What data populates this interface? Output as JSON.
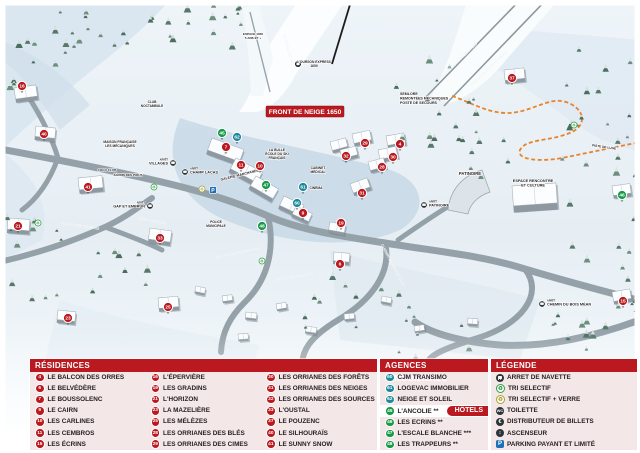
{
  "colors": {
    "red": "#b9191f",
    "green": "#169a48",
    "teal": "#1d8a9c",
    "panel_bg": "#f3e7e7",
    "parking_blue": "#1d70b7",
    "orange": "#e8832a"
  },
  "map": {
    "banner": "FRONT DE NEIGE 1650",
    "arret_word": "ARRÊT",
    "markers": [
      {
        "n": "16",
        "kind": "res",
        "x": 22,
        "y": 86
      },
      {
        "n": "40",
        "kind": "res",
        "x": 44,
        "y": 134
      },
      {
        "n": "21",
        "kind": "res",
        "x": 18,
        "y": 226
      },
      {
        "n": "41",
        "kind": "res",
        "x": 88,
        "y": 187
      },
      {
        "n": "33",
        "kind": "res",
        "x": 160,
        "y": 238
      },
      {
        "n": "25",
        "kind": "res",
        "x": 168,
        "y": 307
      },
      {
        "n": "23",
        "kind": "res",
        "x": 68,
        "y": 318
      },
      {
        "n": "7",
        "kind": "res",
        "x": 226,
        "y": 147
      },
      {
        "n": "11",
        "kind": "res",
        "x": 241,
        "y": 165
      },
      {
        "n": "10",
        "kind": "res",
        "x": 260,
        "y": 166
      },
      {
        "n": "9",
        "kind": "res",
        "x": 303,
        "y": 213
      },
      {
        "n": "19",
        "kind": "res",
        "x": 341,
        "y": 223
      },
      {
        "n": "6",
        "kind": "res",
        "x": 340,
        "y": 264
      },
      {
        "n": "29",
        "kind": "res",
        "x": 365,
        "y": 143
      },
      {
        "n": "4",
        "kind": "res",
        "x": 400,
        "y": 144
      },
      {
        "n": "32",
        "kind": "res",
        "x": 346,
        "y": 156
      },
      {
        "n": "30",
        "kind": "res",
        "x": 393,
        "y": 157
      },
      {
        "n": "28",
        "kind": "res",
        "x": 382,
        "y": 167
      },
      {
        "n": "31",
        "kind": "res",
        "x": 362,
        "y": 193
      },
      {
        "n": "37",
        "kind": "res",
        "x": 512,
        "y": 78
      },
      {
        "n": "15",
        "kind": "res",
        "x": 623,
        "y": 301
      },
      {
        "n": "45",
        "kind": "hotel",
        "x": 222,
        "y": 133
      },
      {
        "n": "47",
        "kind": "hotel",
        "x": 266,
        "y": 185
      },
      {
        "n": "48",
        "kind": "hotel",
        "x": 262,
        "y": 226
      },
      {
        "n": "46",
        "kind": "hotel",
        "x": 622,
        "y": 195
      },
      {
        "n": "62",
        "kind": "agency",
        "x": 237,
        "y": 137
      },
      {
        "n": "61",
        "kind": "agency",
        "x": 303,
        "y": 187
      },
      {
        "n": "60",
        "kind": "agency",
        "x": 297,
        "y": 203
      }
    ],
    "poi_labels": [
      {
        "lines": [
          "SEMLORE",
          "REMONTÉES MÉCANIQUES",
          "POSTE DE SECOURS"
        ],
        "x": 400,
        "y": 95,
        "size": 3.6,
        "anchor": "start"
      },
      {
        "lines": [
          "PATINOIRE"
        ],
        "x": 470,
        "y": 175,
        "size": 4.2,
        "anchor": "middle"
      },
      {
        "lines": [
          "ESPACE RENCONTRE",
          "ET CULTURE"
        ],
        "x": 533,
        "y": 182,
        "size": 3.8,
        "anchor": "middle"
      },
      {
        "lines": [
          "LA BULLE",
          "ÉCOLE DU SKI",
          "FRANÇAIS"
        ],
        "x": 277,
        "y": 151,
        "size": 3.3,
        "anchor": "middle"
      },
      {
        "lines": [
          "CABINET",
          "MÉDICAL"
        ],
        "x": 318,
        "y": 169,
        "size": 3.3,
        "anchor": "middle"
      },
      {
        "lines": [
          "CINÉMA"
        ],
        "x": 316,
        "y": 189,
        "size": 3.3,
        "anchor": "middle"
      },
      {
        "lines": [
          "GALERIE MARCHANDE"
        ],
        "x": 240,
        "y": 176,
        "size": 3.5,
        "anchor": "middle",
        "rot": -14
      },
      {
        "lines": [
          "MAISON FRANÇAISE",
          "LES MÉCANIQUES"
        ],
        "x": 120,
        "y": 143,
        "size": 3.3,
        "anchor": "middle"
      },
      {
        "lines": [
          "CLUB",
          "NOCTAMBULE"
        ],
        "x": 152,
        "y": 103,
        "size": 3.2,
        "anchor": "middle"
      },
      {
        "lines": [
          "COCO CLUB"
        ],
        "x": 107,
        "y": 171,
        "size": 3.1,
        "anchor": "middle"
      },
      {
        "lines": [
          "JARDIN DES PIOUS"
        ],
        "x": 128,
        "y": 176,
        "size": 3.1,
        "anchor": "middle"
      },
      {
        "lines": [
          "POLICE",
          "MUNICIPALE"
        ],
        "x": 216,
        "y": 223,
        "size": 3.2,
        "anchor": "middle"
      },
      {
        "lines": [
          "ESPACE 1650",
          "5 ANS ET +"
        ],
        "x": 253,
        "y": 35,
        "size": 3.1,
        "anchor": "middle"
      },
      {
        "lines": [
          "PISTE DE LUGE"
        ],
        "x": 604,
        "y": 148,
        "size": 3.2,
        "anchor": "middle",
        "rot": 8
      },
      {
        "lines": [
          "L'OURSON EXPRESS",
          "1650"
        ],
        "x": 314,
        "y": 63,
        "size": 3.3,
        "anchor": "middle"
      }
    ],
    "road_labels": [
      {
        "text": "ROUTE DE PRAMOUTON",
        "x": 238,
        "y": 254,
        "rot": -12
      },
      {
        "text": "CHEMIN DU MÉLÈZET",
        "x": 294,
        "y": 278,
        "rot": -10
      },
      {
        "text": "PONT VASSAIL",
        "x": 152,
        "y": 222,
        "rot": 10
      },
      {
        "text": "ALLÉE DES CANONS",
        "x": 80,
        "y": 227,
        "rot": 9
      },
      {
        "text": "CHEMIN DU GRAND CLOT",
        "x": 392,
        "y": 266,
        "rot": 62
      },
      {
        "text": "TÉLÉSIÈGE DU PRÉLONGIS",
        "x": 459,
        "y": 62,
        "rot": -44
      },
      {
        "text": "TÉLÉSIÈGE DU BOIS MÉAN",
        "x": 489,
        "y": 70,
        "rot": -44
      },
      {
        "text": "PLATEAU DE SKI",
        "x": 287,
        "y": 50,
        "rot": 74
      }
    ],
    "bus_stops": [
      {
        "label": "VILLAGES",
        "x": 173,
        "y": 163,
        "side": "left"
      },
      {
        "label": "CHAMP LACAS",
        "x": 185,
        "y": 172,
        "side": "right"
      },
      {
        "label": "GAP ET EMBRUN",
        "x": 150,
        "y": 206,
        "side": "left"
      },
      {
        "label": "PATINOIRE",
        "x": 424,
        "y": 205,
        "side": "right"
      },
      {
        "label": "CHEMIN DU BOIS MÉAN",
        "x": 542,
        "y": 304,
        "side": "right"
      }
    ],
    "eco_points": [
      {
        "x": 38,
        "y": 223
      },
      {
        "x": 154,
        "y": 187
      },
      {
        "x": 262,
        "y": 261
      },
      {
        "x": 574,
        "y": 125
      }
    ],
    "glass_points": [
      {
        "x": 202,
        "y": 189
      }
    ],
    "parking_points": [
      {
        "x": 213,
        "y": 190
      }
    ]
  },
  "panels": {
    "residences": {
      "title": "RÉSIDENCES",
      "items": [
        {
          "n": "4",
          "label": "LE BALCON DES ORRES"
        },
        {
          "n": "6",
          "label": "LE BELVÉDÈRE"
        },
        {
          "n": "7",
          "label": "LE BOUSSOLENC"
        },
        {
          "n": "9",
          "label": "LE CAIRN"
        },
        {
          "n": "10",
          "label": "LES CARLINES"
        },
        {
          "n": "11",
          "label": "LES CEMBROS"
        },
        {
          "n": "15",
          "label": "LES ÉCRINS"
        },
        {
          "n": "16",
          "label": "L'ÉPERVIÈRE"
        },
        {
          "n": "19",
          "label": "LES GRADINS"
        },
        {
          "n": "21",
          "label": "L'HORIZON"
        },
        {
          "n": "23",
          "label": "LA MAZELIÈRE"
        },
        {
          "n": "25",
          "label": "LES MÉLÈZES"
        },
        {
          "n": "28",
          "label": "LES ORRIANES DES BLÉS"
        },
        {
          "n": "29",
          "label": "LES ORRIANES DES CIMES"
        },
        {
          "n": "30",
          "label": "LES ORRIANES DES FORÊTS"
        },
        {
          "n": "31",
          "label": "LES ORRIANES DES NEIGES"
        },
        {
          "n": "32",
          "label": "LES ORRIANES DES SOURCES"
        },
        {
          "n": "33",
          "label": "L'OUSTAL"
        },
        {
          "n": "37",
          "label": "LE POUZENC"
        },
        {
          "n": "40",
          "label": "LE SILHOURAÏS"
        },
        {
          "n": "41",
          "label": "LE SUNNY SNOW"
        }
      ]
    },
    "agencies": {
      "title": "AGENCES IMMOBILIÈRES",
      "items": [
        {
          "n": "60",
          "label": "CJM TRANSIMO"
        },
        {
          "n": "61",
          "label": "LOGEVAC IMMOBILIER"
        },
        {
          "n": "62",
          "label": "NEIGE ET SOLEIL"
        }
      ]
    },
    "hotels": {
      "title": "HÔTELS",
      "items": [
        {
          "n": "45",
          "label": "L'ANCOLIE **"
        },
        {
          "n": "46",
          "label": "LES ECRINS **"
        },
        {
          "n": "47",
          "label": "L'ESCALE BLANCHE ***"
        },
        {
          "n": "48",
          "label": "LES TRAPPEURS **"
        }
      ]
    },
    "legend": {
      "title": "LÉGENDE",
      "items": [
        {
          "icon": "bus",
          "label": "ARRET DE NAVETTE"
        },
        {
          "icon": "recg",
          "label": "TRI SELECTIF"
        },
        {
          "icon": "recy",
          "label": "TRI SELECTIF + VERRE"
        },
        {
          "icon": "wc",
          "label": "TOILETTE"
        },
        {
          "icon": "atm",
          "label": "DISTRIBUTEUR DE BILLETS"
        },
        {
          "icon": "elev",
          "label": "ASCENSEUR"
        },
        {
          "icon": "park",
          "label": "PARKING PAYANT ET LIMITÉ"
        }
      ]
    }
  }
}
